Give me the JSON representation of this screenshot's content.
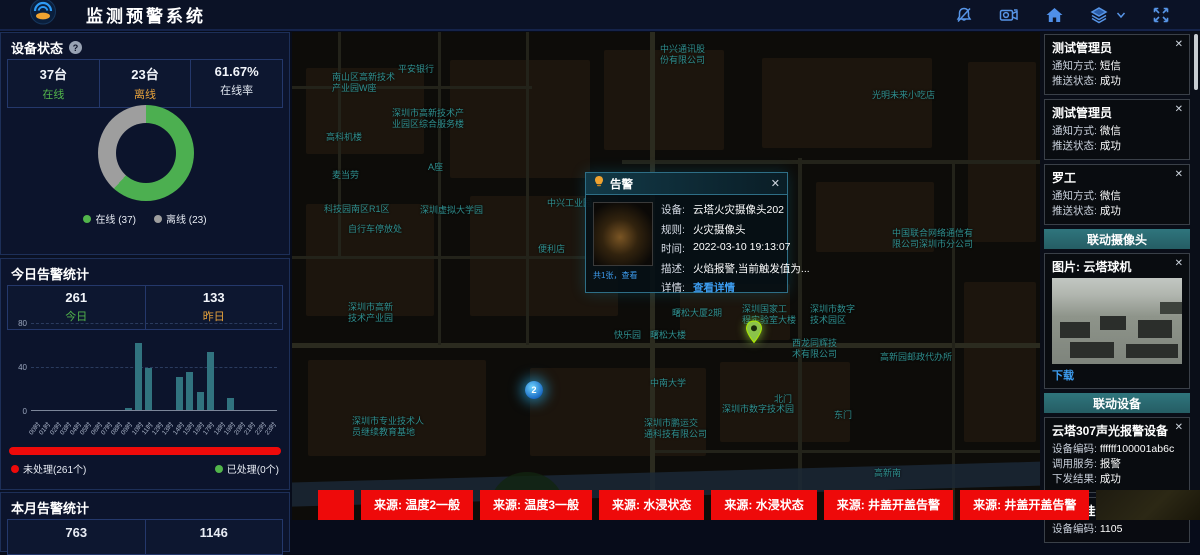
{
  "ui": {
    "close_glyph": "✕",
    "help_glyph": "?"
  },
  "colors": {
    "accent": "#4f8fe8",
    "green": "#52b54b",
    "orange": "#e6a23c",
    "red": "#ee0a0a",
    "link": "#3d9df0",
    "teal_header": "#2a6b72",
    "bar": "#31737f",
    "offline_gray": "#9e9e9e"
  },
  "header": {
    "title": "监测预警系统",
    "icons": [
      "bell-off-icon",
      "video-camera-icon",
      "home-icon",
      "layers-icon",
      "chevron-down-icon",
      "fullscreen-icon"
    ]
  },
  "left": {
    "device_status": {
      "title": "设备状态",
      "stats": [
        {
          "value": "37台",
          "label": "在线"
        },
        {
          "value": "23台",
          "label": "离线"
        },
        {
          "value": "61.67%",
          "label": "在线率"
        }
      ],
      "legend": [
        {
          "label": "在线 (37)",
          "color": "#52b54b"
        },
        {
          "label": "离线 (23)",
          "color": "#9e9e9e"
        }
      ],
      "chart_data": {
        "type": "pie",
        "labels": [
          "在线",
          "离线"
        ],
        "values": [
          37,
          23
        ],
        "colors": [
          "#4caf50",
          "#9e9e9e"
        ]
      }
    },
    "today": {
      "title": "今日告警统计",
      "stats": [
        {
          "value": "261",
          "label": "今日"
        },
        {
          "value": "133",
          "label": "昨日"
        }
      ],
      "chart_data": {
        "type": "bar",
        "categories": [
          "00时",
          "01时",
          "02时",
          "03时",
          "04时",
          "05时",
          "06时",
          "07时",
          "08时",
          "09时",
          "10时",
          "11时",
          "12时",
          "13时",
          "14时",
          "15时",
          "16时",
          "17时",
          "18时",
          "19时",
          "20时",
          "21时",
          "22时",
          "23时"
        ],
        "values": [
          0,
          0,
          0,
          0,
          0,
          0,
          0,
          0,
          0,
          2,
          62,
          39,
          0,
          0,
          30,
          35,
          17,
          53,
          0,
          11,
          0,
          0,
          0,
          0
        ],
        "ylim": [
          0,
          80
        ],
        "yticks": [
          0,
          40,
          80
        ],
        "title": "",
        "xlabel": "",
        "ylabel": ""
      },
      "progress": {
        "percent_unhandled": 100,
        "unhandled": "未处理(261个)",
        "handled": "已处理(0个)"
      }
    },
    "month": {
      "title": "本月告警统计",
      "values": [
        "763",
        "1146"
      ]
    }
  },
  "map": {
    "cluster": {
      "count": "2",
      "x": 233,
      "y": 349
    },
    "pin": {
      "x": 453,
      "y": 288
    },
    "labels": [
      {
        "text": "中兴通讯股\n份有限公司",
        "x": 368,
        "y": 12
      },
      {
        "text": "南山区高新技术\n产业园W座",
        "x": 40,
        "y": 40
      },
      {
        "text": "平安银行",
        "x": 106,
        "y": 32
      },
      {
        "text": "深圳市高新技术产\n业园区综合服务楼",
        "x": 100,
        "y": 76
      },
      {
        "text": "光明未来小吃店",
        "x": 580,
        "y": 58
      },
      {
        "text": "高科机楼",
        "x": 34,
        "y": 100
      },
      {
        "text": "麦当劳",
        "x": 40,
        "y": 138
      },
      {
        "text": "A座",
        "x": 136,
        "y": 130
      },
      {
        "text": "中兴工业园",
        "x": 255,
        "y": 166
      },
      {
        "text": "科技园南区R1区",
        "x": 32,
        "y": 172
      },
      {
        "text": "深圳虚拟大学园",
        "x": 128,
        "y": 173
      },
      {
        "text": "自行车停放处",
        "x": 56,
        "y": 192
      },
      {
        "text": "便利店",
        "x": 246,
        "y": 212
      },
      {
        "text": "中国联合网络通信有\n限公司深圳市分公司",
        "x": 600,
        "y": 196
      },
      {
        "text": "深圳市高新\n技术产业园",
        "x": 56,
        "y": 270
      },
      {
        "text": "快乐园",
        "x": 322,
        "y": 298
      },
      {
        "text": "曙松大厦2期",
        "x": 380,
        "y": 276
      },
      {
        "text": "曙松大楼",
        "x": 358,
        "y": 298
      },
      {
        "text": "深圳国家工\n程实验室大楼",
        "x": 450,
        "y": 272
      },
      {
        "text": "深圳市数字\n技术园区",
        "x": 518,
        "y": 272
      },
      {
        "text": "西龙同辉技\n术有限公司",
        "x": 500,
        "y": 306
      },
      {
        "text": "高新园邮政代办所",
        "x": 588,
        "y": 320
      },
      {
        "text": "中南大学",
        "x": 358,
        "y": 346
      },
      {
        "text": "深圳市数字技术园",
        "x": 430,
        "y": 372
      },
      {
        "text": "北门",
        "x": 482,
        "y": 362
      },
      {
        "text": "东门",
        "x": 542,
        "y": 378
      },
      {
        "text": "深圳市鹏运交\n通科技有限公司",
        "x": 352,
        "y": 386
      },
      {
        "text": "深圳市专业技术人\n员继续教育基地",
        "x": 60,
        "y": 384
      },
      {
        "text": "高新南",
        "x": 582,
        "y": 436
      }
    ]
  },
  "popup": {
    "title": "告警",
    "thumb_caption": "共1张，查看",
    "fields": [
      {
        "label": "设备:",
        "value": "云塔火灾摄像头202"
      },
      {
        "label": "规则:",
        "value": "火灾摄像头"
      },
      {
        "label": "时间:",
        "value": "2022-03-10 19:13:07"
      },
      {
        "label": "描述:",
        "value": "火焰报警,当前触发值为..."
      }
    ],
    "detail_label": "详情:",
    "detail_link": "查看详情"
  },
  "notifications": [
    {
      "name": "测试管理员",
      "method_label": "通知方式:",
      "method": "短信",
      "status_label": "推送状态:",
      "status": "成功"
    },
    {
      "name": "测试管理员",
      "method_label": "通知方式:",
      "method": "微信",
      "status_label": "推送状态:",
      "status": "成功"
    },
    {
      "name": "罗工",
      "method_label": "通知方式:",
      "method": "微信",
      "status_label": "推送状态:",
      "status": "成功"
    }
  ],
  "camera": {
    "header": "联动摄像头",
    "image_label": "图片: 云塔球机",
    "download": "下载"
  },
  "devices": {
    "header": "联动设备",
    "cards": [
      {
        "name": "云塔307声光报警设备",
        "rows": [
          {
            "label": "设备编码:",
            "value": "ffffff100001ab6c",
            "status": false
          },
          {
            "label": "调用服务:",
            "value": "报警",
            "status": false
          },
          {
            "label": "下发结果:",
            "value": "成功",
            "status": true
          }
        ]
      },
      {
        "name": "SIP壁挂音箱1105",
        "rows": [
          {
            "label": "设备编码:",
            "value": "1105",
            "status": false
          }
        ]
      }
    ]
  },
  "ticker": {
    "items": [
      {
        "text": "",
        "type": "empty"
      },
      {
        "text": "来源: 温度2一般",
        "type": "red"
      },
      {
        "text": "来源: 温度3一般",
        "type": "red"
      },
      {
        "text": "来源: 水浸状态",
        "type": "red"
      },
      {
        "text": "来源: 水浸状态",
        "type": "red"
      },
      {
        "text": "来源: 井盖开盖告警",
        "type": "red"
      },
      {
        "text": "来源: 井盖开盖告警",
        "type": "red"
      },
      {
        "text": "",
        "type": "thumb-dark"
      },
      {
        "text": "",
        "type": "thumb-green"
      }
    ]
  }
}
